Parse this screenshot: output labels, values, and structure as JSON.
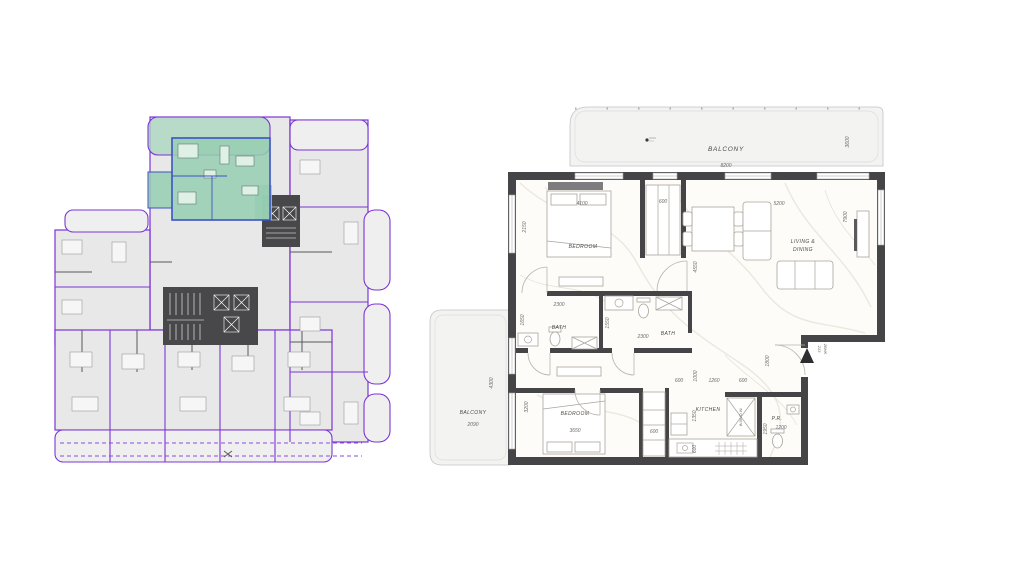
{
  "page": {
    "background": "#ffffff"
  },
  "key_plan": {
    "unit_outline_color": "#7c35d6",
    "highlight_fill": "#96ceb2",
    "highlight_outline": "#3d52c4",
    "core_color": "#48484a"
  },
  "detail_plan": {
    "wall_color": "#454547",
    "balcony_top": {
      "label": "BALCONY",
      "width": "8200",
      "depth": "3600"
    },
    "balcony_side": {
      "label": "BALCONY",
      "width": "2090",
      "depth": "4300"
    },
    "bedroom1": {
      "label": "BEDROOM",
      "width": "4100",
      "depth": "2150"
    },
    "closet1": {
      "width": "600"
    },
    "living": {
      "label_line1": "LIVING &",
      "label_line2": "DINING",
      "width": "5200",
      "depth": "4550",
      "side": "7900"
    },
    "bath1": {
      "label": "BATH",
      "width": "2300",
      "depth": "1650"
    },
    "bath2": {
      "label": "BATH",
      "width": "2300",
      "depth": "1550"
    },
    "bedroom2": {
      "label": "BEDROOM",
      "width": "3650",
      "depth": "3200"
    },
    "closet2": {
      "width": "600"
    },
    "kitchen": {
      "label": "KITCHEN",
      "depth": "1350",
      "counter": "600",
      "appliance": "W.M./D.W."
    },
    "powder": {
      "label": "P.R.",
      "width": "1200",
      "depth": "1950"
    },
    "hall": {
      "d1": "600",
      "d2": "1000",
      "d3": "1260",
      "d4": "600",
      "entry_depth": "1800"
    },
    "entry": {
      "unit": "213",
      "type": "2BHK"
    }
  }
}
